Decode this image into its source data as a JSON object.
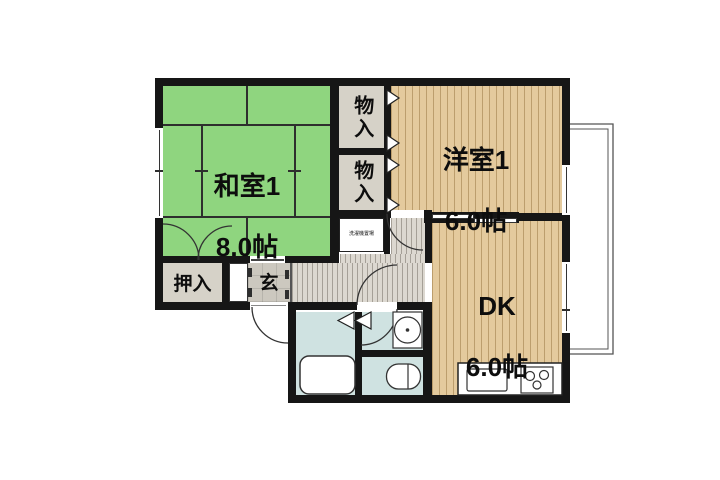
{
  "floor_plan": {
    "rooms": {
      "washitsu": {
        "label": "和室1",
        "area": "8.0帖"
      },
      "youshitsu": {
        "label": "洋室1",
        "area": "6.0帖"
      },
      "dk": {
        "label": "DK",
        "area": "6.0帖"
      },
      "storage_top": {
        "label": "物入"
      },
      "storage_bottom": {
        "label": "物入"
      },
      "oshiire": {
        "label": "押入"
      },
      "genkan": {
        "label": "玄"
      },
      "washer_space": {
        "label": "洗濯機置場"
      }
    },
    "colors": {
      "tatami_green": "#8fd57f",
      "wood_tan": "#e4ca9d",
      "storage_gray": "#d6d2c8",
      "corridor_gray": "#dcd8d0",
      "wet_area_blue": "#cfe2e1",
      "wall_black": "#161616"
    }
  }
}
